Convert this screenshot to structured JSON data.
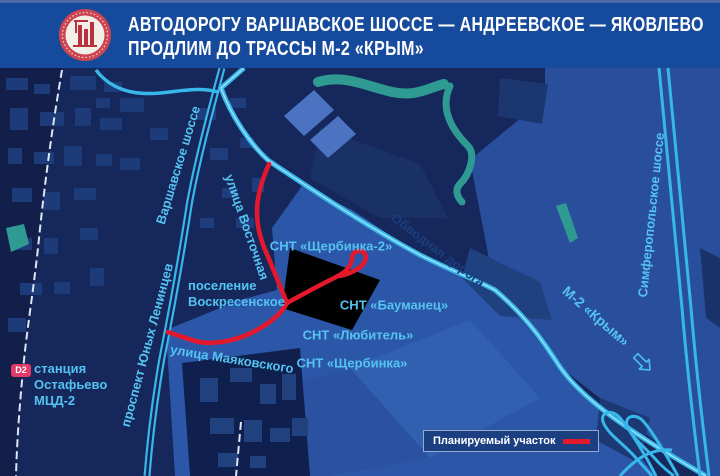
{
  "header": {
    "title_line1": "АВТОДОРОГУ ВАРШАВСКОЕ ШОССЕ — АНДРЕЕВСКОЕ — ЯКОВЛЕВО",
    "title_line2": "ПРОДЛИМ ДО ТРАССЫ М-2 «КРЫМ»"
  },
  "map_labels": {
    "varshavskoe_shosse": "Варшавское шоссе",
    "ulitsa_vostochnaya": "улица Восточная",
    "obvodnaya_doroga": "Обводная дорога",
    "simferopolskoe_shosse": "Симферопольское шоссе",
    "m2_krym": "М-2 «Крым»",
    "poselenie_line1": "поселение",
    "poselenie_line2": "Воскресенское",
    "ulitsa_mayakovskogo": "улица Маяковского",
    "prospekt_yunyh_lenintsev": "проспект Юных Ленинцев",
    "snt_shcherbinka2": "СНТ «Щербинка-2»",
    "snt_baumanets": "СНТ «Бауманец»",
    "snt_lyubitel": "СНТ «Любитель»",
    "snt_shcherbinka": "СНТ «Щербинка»"
  },
  "station": {
    "badge": "D2",
    "line1": "станция",
    "line2": "Остафьево",
    "line3": "МЦД-2"
  },
  "legend": {
    "label": "Планируемый участок"
  },
  "icons": {
    "logo": "moscow-construction-emblem",
    "arrow": "direction-arrow-south-east"
  },
  "colors": {
    "header_bg": "#164a9c",
    "map_bg": "#16275c",
    "road_cyan": "#38b7e9",
    "label_cyan": "#54c3f1",
    "planned_red": "#e4182c",
    "water_teal": "#2f9a92",
    "d2_badge": "#e13a66",
    "field_blue": "#2c57a8"
  }
}
